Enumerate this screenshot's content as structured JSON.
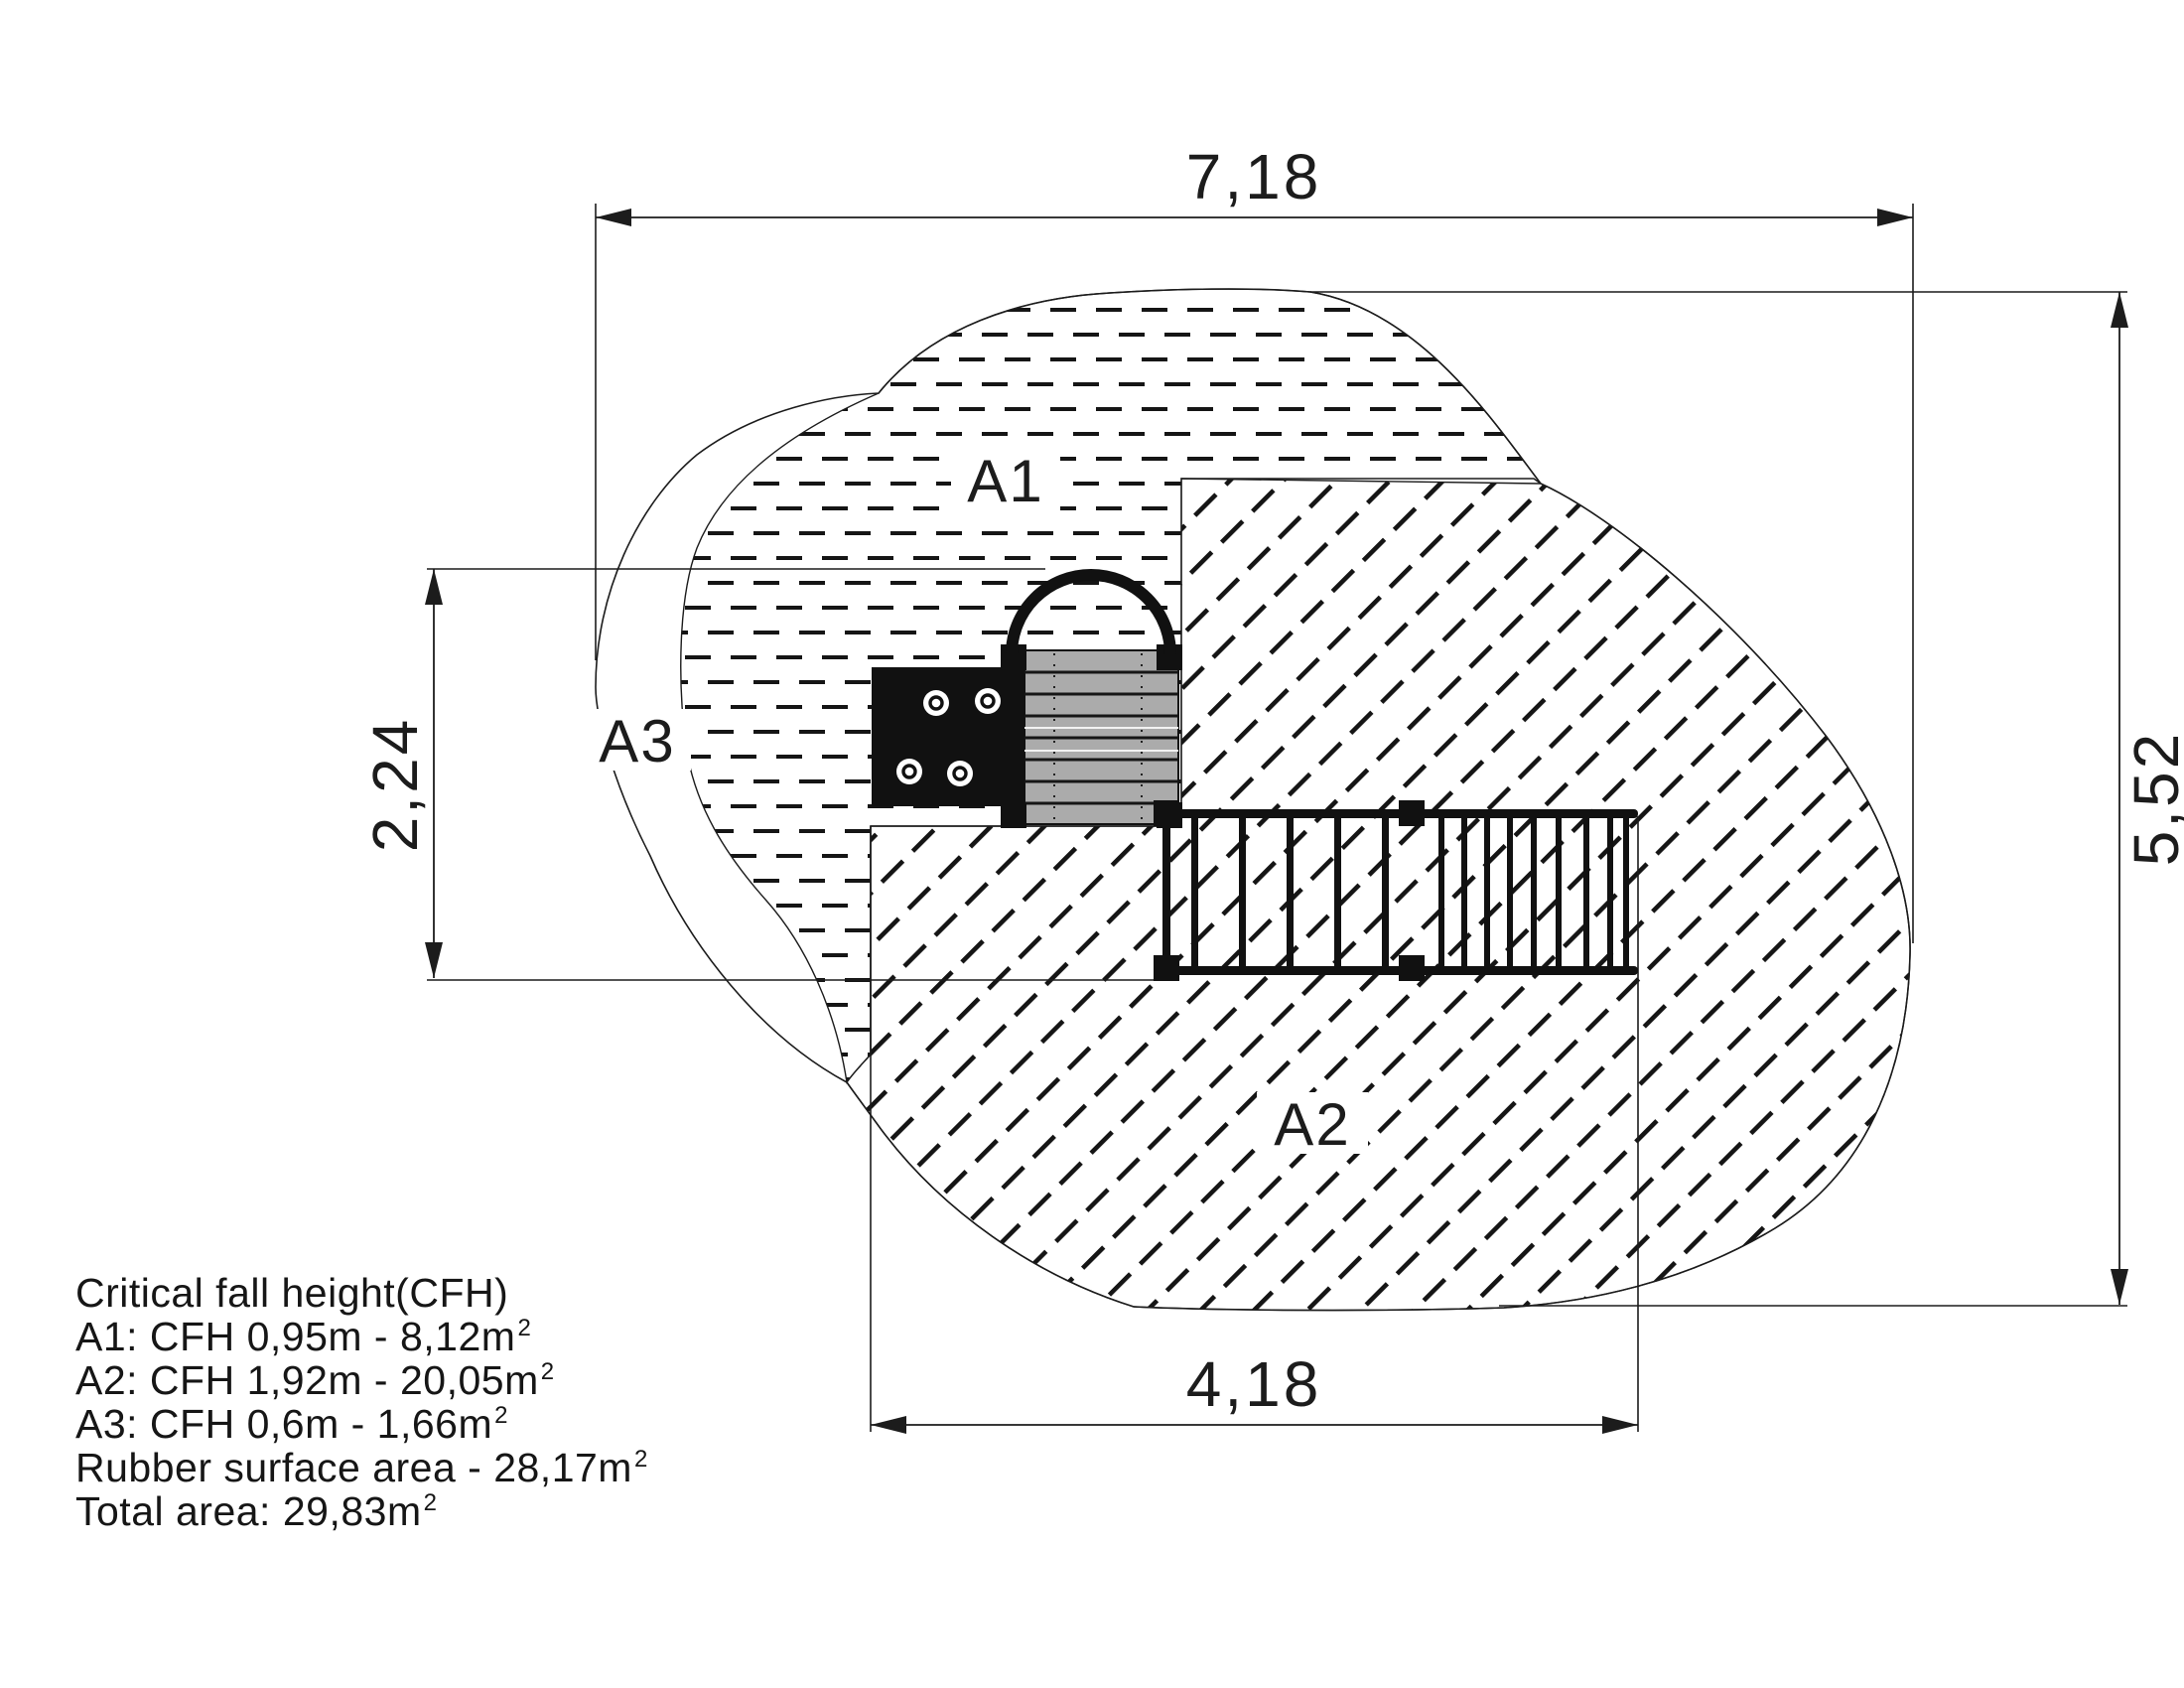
{
  "drawing": {
    "dimensions": {
      "total_width": "7,18",
      "total_height": "5,52",
      "equipment_depth": "2,24",
      "rubber_width": "4,18"
    },
    "areas": {
      "a1": "A1",
      "a2": "A2",
      "a3": "A3"
    },
    "notes": {
      "title": "Critical fall height(CFH)",
      "lines": [
        {
          "text": "A1: CFH 0,95m - 8,12m",
          "sup": "2"
        },
        {
          "text": "A2: CFH 1,92m - 20,05m",
          "sup": "2"
        },
        {
          "text": "A3: CFH 0,6m - 1,66m",
          "sup": "2"
        },
        {
          "text": "Rubber surface area - 28,17m",
          "sup": "2"
        },
        {
          "text": "Total area: 29,83m",
          "sup": "2"
        }
      ]
    },
    "colors": {
      "line": "#1c1c1c",
      "deck_fill": "#ababab",
      "equipment_fill": "#111111",
      "background": "#ffffff"
    }
  }
}
